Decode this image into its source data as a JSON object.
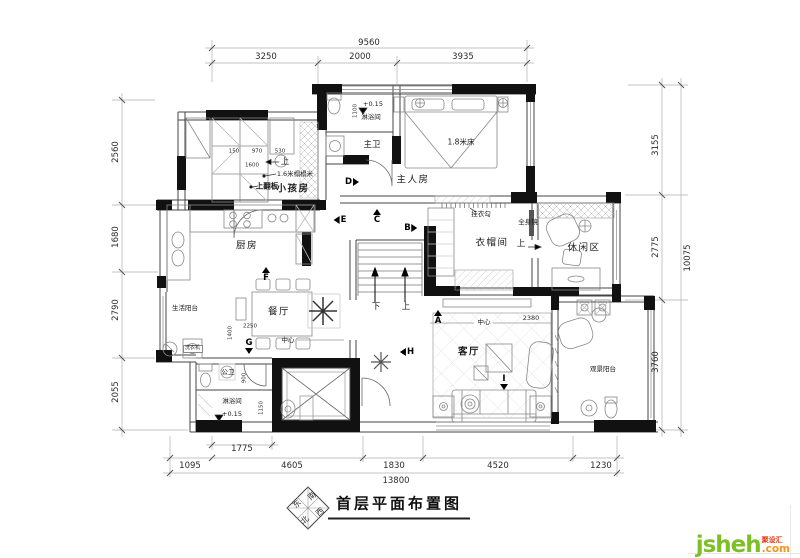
{
  "title": "首层平面布置图",
  "compass": {
    "south": "南",
    "east": "东",
    "west": "西",
    "north": "北"
  },
  "watermark": {
    "name": "jsheh",
    "tld": ".com",
    "badge": "聚设汇"
  },
  "rooms": {
    "master_bedroom": "主人房",
    "master_bath": "主卫",
    "shower_top": "淋浴间",
    "kids_room": "小孩房",
    "kitchen": "厨房",
    "dining": "餐厅",
    "living": "客厅",
    "cloakroom": "衣帽间",
    "leisure": "休闲区",
    "life_balcony": "生活阳台",
    "view_balcony": "观景阳台",
    "public_bath": "公卫",
    "shower_bottom": "淋浴间"
  },
  "annotations": {
    "bed": "1.8米床",
    "tatami": "1.6米榻榻米",
    "flip_board": "上翻板",
    "washer": "洗衣机",
    "hook": "挂衣勾",
    "mirror": "全身镜",
    "center_dining": "中心",
    "center_living": "中心",
    "up_kids": "上",
    "up_leisure": "上",
    "up_stairs": "上",
    "down_stairs": "下",
    "level_top": "+0.15",
    "level_bottom": "+0.15"
  },
  "dimensions": {
    "top": {
      "total": "9560",
      "seg1": "3250",
      "seg2": "2000",
      "seg3": "3935"
    },
    "left": {
      "d1": "2560",
      "d2": "1680",
      "d3": "2790",
      "d4": "2055"
    },
    "right": {
      "d1": "3155",
      "d2": "2775",
      "d3": "3760",
      "total": "10075"
    },
    "bottom": {
      "d0": "1775",
      "d1": "1095",
      "d2": "4605",
      "d3": "1830",
      "d4": "4520",
      "d5": "1230",
      "total": "13800"
    },
    "inner": {
      "i1": "1100",
      "i2": "150",
      "i3": "970",
      "i4": "530",
      "i5": "1600",
      "i6": "1400",
      "i7": "2250",
      "i8": "900",
      "i9": "1150",
      "i10": "2380"
    }
  },
  "view_markers": {
    "a": "A",
    "b": "B",
    "c": "C",
    "d": "D",
    "e": "E",
    "f": "F",
    "g": "G",
    "h": "H",
    "i": "I"
  }
}
